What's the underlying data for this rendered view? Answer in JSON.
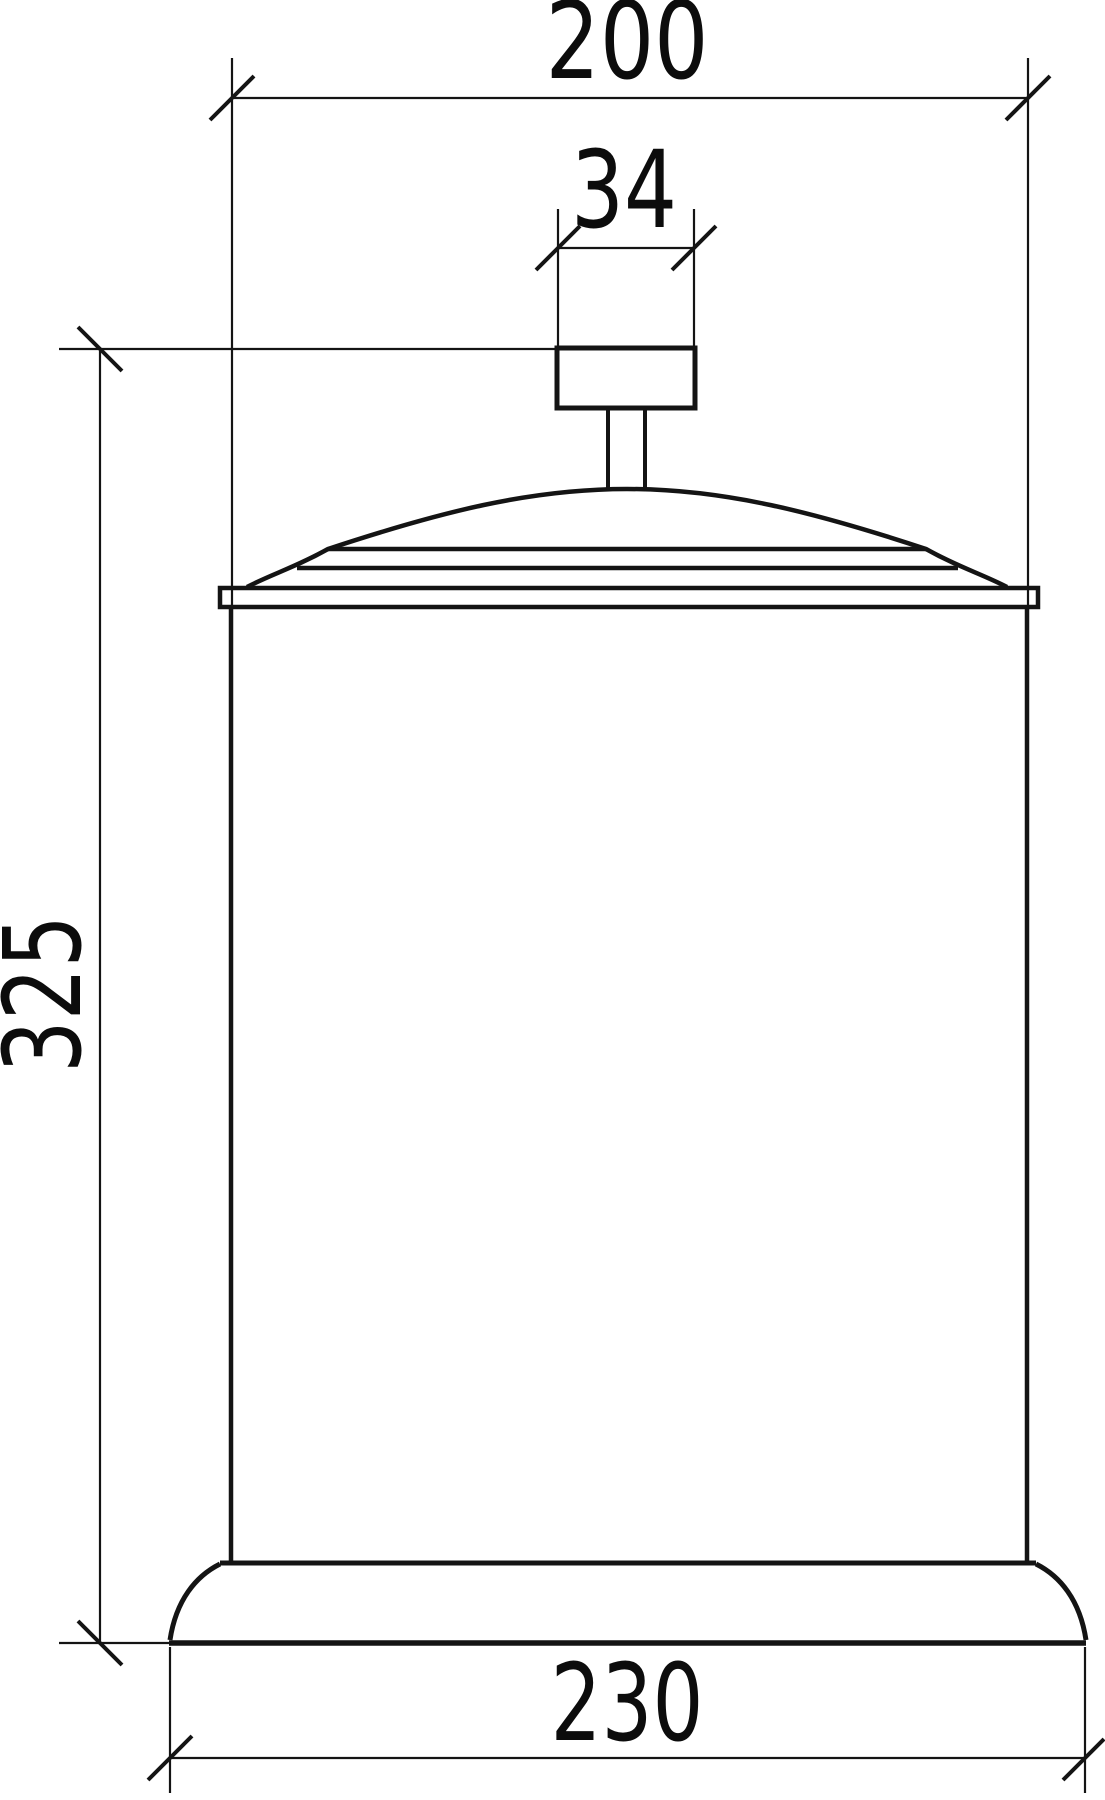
{
  "drawing": {
    "colors": {
      "background": "#ffffff",
      "line": "#141414",
      "text": "#0c0c0c"
    },
    "dimensions": {
      "bin_diameter": {
        "value": "200"
      },
      "knob_width": {
        "value": "34"
      },
      "overall_height": {
        "value": "325"
      },
      "base_diameter": {
        "value": "230"
      }
    }
  }
}
